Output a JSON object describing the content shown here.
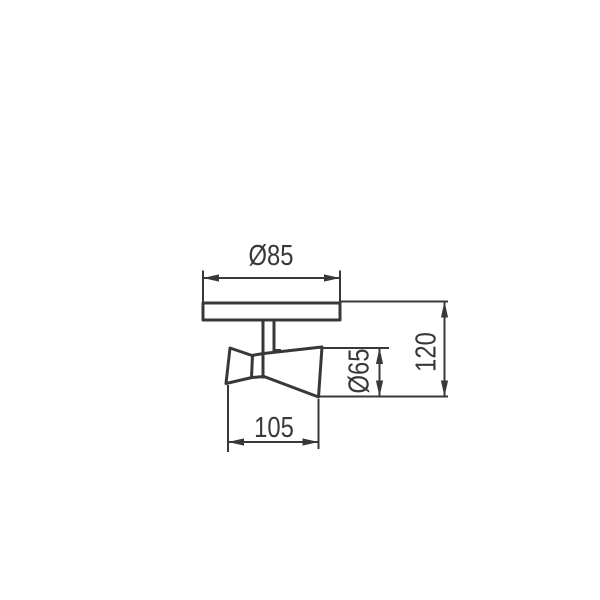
{
  "drawing": {
    "background_color": "#ffffff",
    "line_color": "#383838",
    "dimensions": {
      "plate_diameter": {
        "label": "Ø85",
        "value": 85
      },
      "head_length": {
        "label": "105",
        "value": 105
      },
      "head_diameter": {
        "label": "Ø65",
        "value": 65
      },
      "overall_height": {
        "label": "120",
        "value": 120
      }
    }
  }
}
